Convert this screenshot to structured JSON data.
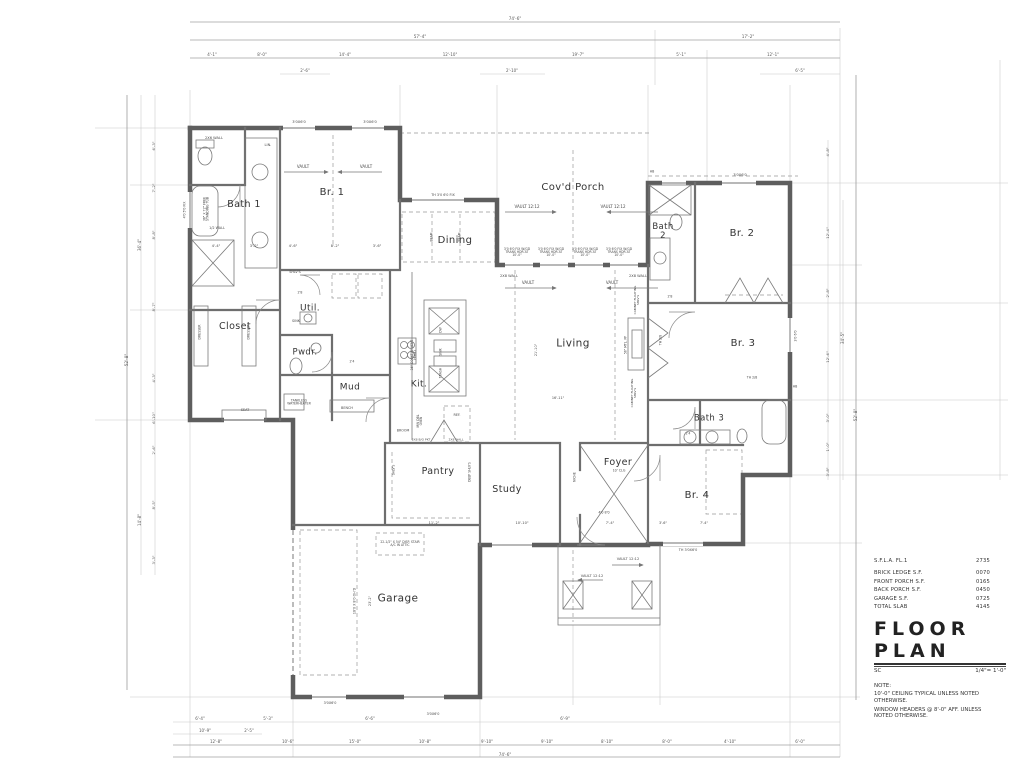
{
  "title_block": {
    "rows": [
      {
        "label": "S.F.L.A. FL.1",
        "value": "2735"
      },
      {
        "label": "BRICK LEDGE S.F.",
        "value": "0070"
      },
      {
        "label": "FRONT PORCH S.F.",
        "value": "0165"
      },
      {
        "label": "BACK PORCH S.F.",
        "value": "0450"
      },
      {
        "label": "GARAGE S.F.",
        "value": "0725"
      },
      {
        "label": "TOTAL SLAB",
        "value": "4145"
      }
    ],
    "title": "FLOOR PLAN",
    "sheet": "SC",
    "scale": "1/4\"= 1'-0\"",
    "note_heading": "NOTE:",
    "notes": [
      "10'-0\" CEILING TYPICAL UNLESS NOTED OTHERWISE.",
      "WINDOW HEADERS @ 8'-0\" AFF. UNLESS NOTED OTHERWISE."
    ]
  },
  "labels": {
    "rooms": [
      {
        "t": "Bath 1",
        "x": 244,
        "y": 205,
        "s": 9.5
      },
      {
        "t": "Br. 1",
        "x": 332,
        "y": 193,
        "s": 10
      },
      {
        "t": "Cov'd Porch",
        "x": 573,
        "y": 188,
        "s": 10
      },
      {
        "t": "Bath 2",
        "x": 663,
        "y": 232,
        "s": 8.5,
        "w": 26
      },
      {
        "t": "Br. 2",
        "x": 742,
        "y": 234,
        "s": 10
      },
      {
        "t": "Dining",
        "x": 455,
        "y": 241,
        "s": 10
      },
      {
        "t": "Closet",
        "x": 235,
        "y": 327,
        "s": 9.5
      },
      {
        "t": "Util.",
        "x": 310,
        "y": 309,
        "s": 9
      },
      {
        "t": "Pwdr.",
        "x": 305,
        "y": 353,
        "s": 8.5
      },
      {
        "t": "Mud",
        "x": 350,
        "y": 388,
        "s": 9
      },
      {
        "t": "Kit.",
        "x": 419,
        "y": 385,
        "s": 9
      },
      {
        "t": "Living",
        "x": 573,
        "y": 344,
        "s": 10.5
      },
      {
        "t": "Br. 3",
        "x": 743,
        "y": 344,
        "s": 10
      },
      {
        "t": "Pantry",
        "x": 438,
        "y": 472,
        "s": 9.5
      },
      {
        "t": "Study",
        "x": 507,
        "y": 490,
        "s": 9.5
      },
      {
        "t": "Foyer",
        "x": 618,
        "y": 463,
        "s": 9.5
      },
      {
        "t": "Bath 3",
        "x": 709,
        "y": 419,
        "s": 8.5
      },
      {
        "t": "Br. 4",
        "x": 697,
        "y": 496,
        "s": 10
      },
      {
        "t": "Garage",
        "x": 398,
        "y": 599,
        "s": 10.5
      }
    ],
    "annotations": [
      {
        "t": "2X6 WALL",
        "x": 214,
        "y": 139,
        "s": 3.6
      },
      {
        "t": "LIN.",
        "x": 268,
        "y": 146,
        "s": 3.6
      },
      {
        "t": "3'0X6'0",
        "x": 299,
        "y": 123,
        "s": 3.6
      },
      {
        "t": "3'0X6'0",
        "x": 370,
        "y": 123,
        "s": 3.6
      },
      {
        "t": "3'0X6'0",
        "x": 740,
        "y": 176,
        "s": 3.6
      },
      {
        "t": "VAULT",
        "x": 303,
        "y": 167,
        "s": 4
      },
      {
        "t": "VAULT",
        "x": 366,
        "y": 167,
        "s": 4
      },
      {
        "t": "VAULT 12:12",
        "x": 527,
        "y": 207,
        "s": 4
      },
      {
        "t": "VAULT 12:12",
        "x": 613,
        "y": 207,
        "s": 4
      },
      {
        "t": "VAULT",
        "x": 528,
        "y": 283,
        "s": 4
      },
      {
        "t": "VAULT",
        "x": 612,
        "y": 283,
        "s": 4
      },
      {
        "t": "VAULT 12:12",
        "x": 592,
        "y": 577,
        "s": 3.6
      },
      {
        "t": "VAULT 12:12",
        "x": 628,
        "y": 560,
        "s": 3.6
      },
      {
        "t": "36\" X 72\" FREE STANDING TUB",
        "x": 207,
        "y": 209,
        "s": 3.2,
        "r": -90,
        "w": 34
      },
      {
        "t": "1/2 WALL",
        "x": 217,
        "y": 229,
        "s": 3.4
      },
      {
        "t": "4'0 5'0 FIX",
        "x": 185,
        "y": 210,
        "s": 3.2,
        "r": -90
      },
      {
        "t": "4'-4\"",
        "x": 216,
        "y": 247,
        "s": 3.6
      },
      {
        "t": "3'-2\"",
        "x": 254,
        "y": 247,
        "s": 3.6
      },
      {
        "t": "4'-6\"",
        "x": 293,
        "y": 247,
        "s": 3.6
      },
      {
        "t": "8'-2\"",
        "x": 335,
        "y": 247,
        "s": 3.6
      },
      {
        "t": "3'-6\"",
        "x": 377,
        "y": 247,
        "s": 3.6
      },
      {
        "t": "DRESSER",
        "x": 200,
        "y": 332,
        "s": 3.2,
        "r": -90
      },
      {
        "t": "DRESSER",
        "x": 249,
        "y": 332,
        "s": 3.2,
        "r": -90
      },
      {
        "t": "SHLV'S",
        "x": 295,
        "y": 273,
        "s": 3.4
      },
      {
        "t": "SINK",
        "x": 296,
        "y": 322,
        "s": 3.4
      },
      {
        "t": "2X8 WALL",
        "x": 509,
        "y": 277,
        "s": 3.6
      },
      {
        "t": "2X8 WALL",
        "x": 638,
        "y": 277,
        "s": 3.6
      },
      {
        "t": "TH 3'0 6'0 FIX",
        "x": 443,
        "y": 196,
        "s": 3.4
      },
      {
        "t": "3'0 6'0 FIX W/GD TRANS HDR AT 10'-0\"",
        "x": 517,
        "y": 253,
        "s": 3.1,
        "w": 28
      },
      {
        "t": "3'0 6'0 FIX W/GD TRANS HDR AT 10'-0\"",
        "x": 551,
        "y": 253,
        "s": 3.1,
        "w": 28
      },
      {
        "t": "3'0 6'0 FIX W/GD TRANS HDR AT 10'-0\"",
        "x": 585,
        "y": 253,
        "s": 3.1,
        "w": 28
      },
      {
        "t": "3'0 6'0 FIX W/GD TRANS HDR AT 10'-0\"",
        "x": 619,
        "y": 253,
        "s": 3.1,
        "w": 28
      },
      {
        "t": "TANKLESS WATERHEATER",
        "x": 299,
        "y": 403,
        "s": 3.2,
        "w": 32
      },
      {
        "t": "SEAT",
        "x": 245,
        "y": 411,
        "s": 3.4
      },
      {
        "t": "BENCH",
        "x": 347,
        "y": 409,
        "s": 3.4
      },
      {
        "t": "BROOM",
        "x": 403,
        "y": 431,
        "s": 3.3
      },
      {
        "t": "36\" COOKTOP VENT HOOD",
        "x": 414,
        "y": 355,
        "s": 3.1,
        "r": -90,
        "w": 36
      },
      {
        "t": "MW DBL OVEN",
        "x": 420,
        "y": 421,
        "s": 3.1,
        "r": -90,
        "w": 20
      },
      {
        "t": "REF.",
        "x": 457,
        "y": 416,
        "s": 3.4
      },
      {
        "t": "DW",
        "x": 441,
        "y": 330,
        "s": 3.1,
        "r": -90
      },
      {
        "t": "SINK",
        "x": 441,
        "y": 352,
        "s": 3.1,
        "r": -90
      },
      {
        "t": "TRASH",
        "x": 441,
        "y": 373,
        "s": 3.1,
        "r": -90
      },
      {
        "t": "BEAM",
        "x": 432,
        "y": 237,
        "s": 3.1,
        "r": -90
      },
      {
        "t": "BEAM",
        "x": 460,
        "y": 237,
        "s": 3.1,
        "r": -90
      },
      {
        "t": "56\" MTL. FP",
        "x": 626,
        "y": 345,
        "s": 3.1,
        "r": -90
      },
      {
        "t": "CABINET FLOATING SHLV'S",
        "x": 637,
        "y": 300,
        "s": 3,
        "r": -90,
        "w": 34
      },
      {
        "t": "CABINET FLOATING SHLV'S",
        "x": 634,
        "y": 393,
        "s": 3,
        "r": -90,
        "w": 34
      },
      {
        "t": "21'-10\"",
        "x": 537,
        "y": 350,
        "s": 3.4,
        "r": -90
      },
      {
        "t": "16'-11\"",
        "x": 558,
        "y": 399,
        "s": 3.4
      },
      {
        "t": "DEEP SHLV'S",
        "x": 470,
        "y": 472,
        "s": 3.1,
        "r": -90,
        "w": 20
      },
      {
        "t": "SHLV'S",
        "x": 394,
        "y": 470,
        "s": 3.1,
        "r": -90
      },
      {
        "t": "NICHE",
        "x": 575,
        "y": 477,
        "s": 3.1,
        "r": -90
      },
      {
        "t": "11'-2\"",
        "x": 434,
        "y": 524,
        "s": 3.6
      },
      {
        "t": "10'-10\"",
        "x": 522,
        "y": 524,
        "s": 3.6
      },
      {
        "t": "7'-4\"",
        "x": 610,
        "y": 524,
        "s": 3.6
      },
      {
        "t": "4'0 8'0",
        "x": 604,
        "y": 513,
        "s": 3.3
      },
      {
        "t": "10' CLG",
        "x": 619,
        "y": 471,
        "s": 3.3
      },
      {
        "t": "22-1/2\" X 54\" DISP. STAIR A/C IN ATTIC",
        "x": 400,
        "y": 544,
        "s": 3.1,
        "w": 40
      },
      {
        "t": "18'0 X 8'0 OH'D",
        "x": 355,
        "y": 601,
        "s": 3.3,
        "r": -90
      },
      {
        "t": "23'-2\"",
        "x": 371,
        "y": 601,
        "s": 3.4,
        "r": -90
      },
      {
        "t": "3'0X6'0",
        "x": 330,
        "y": 704,
        "s": 3.4
      },
      {
        "t": "3'0X6'0",
        "x": 433,
        "y": 715,
        "s": 3.4
      },
      {
        "t": "TH 3'0X6'0",
        "x": 688,
        "y": 551,
        "s": 3.4
      },
      {
        "t": "3'0 6'0",
        "x": 796,
        "y": 336,
        "s": 3.3,
        "r": -90
      },
      {
        "t": "HB",
        "x": 795,
        "y": 387,
        "s": 3.2
      },
      {
        "t": "HB",
        "x": 652,
        "y": 172,
        "s": 3.2
      },
      {
        "t": "2'8",
        "x": 300,
        "y": 293,
        "s": 3.2
      },
      {
        "t": "2'4",
        "x": 352,
        "y": 362,
        "s": 3.2
      },
      {
        "t": "2'8",
        "x": 670,
        "y": 297,
        "s": 3.2
      },
      {
        "t": "2'4",
        "x": 688,
        "y": 434,
        "s": 3.2
      },
      {
        "t": "TH 2/8",
        "x": 752,
        "y": 378,
        "s": 3.2
      },
      {
        "t": "TH 2/8",
        "x": 661,
        "y": 340,
        "s": 3.2,
        "r": -90
      },
      {
        "t": "3'-6\"",
        "x": 663,
        "y": 524,
        "s": 3.4
      },
      {
        "t": "7'-4\"",
        "x": 704,
        "y": 524,
        "s": 3.4
      },
      {
        "t": "2X8 B/O PKT",
        "x": 421,
        "y": 440,
        "s": 3
      },
      {
        "t": "2X8 WALL",
        "x": 456,
        "y": 440,
        "s": 3
      }
    ],
    "dimensions": [
      {
        "t": "74'-6\"",
        "x": 515,
        "y": 19,
        "s": 4.2
      },
      {
        "t": "57'-4\"",
        "x": 420,
        "y": 37,
        "s": 4.2
      },
      {
        "t": "17'-2\"",
        "x": 748,
        "y": 37,
        "s": 4.2
      },
      {
        "t": "4'-1\"",
        "x": 212,
        "y": 55,
        "s": 4
      },
      {
        "t": "8'-0\"",
        "x": 262,
        "y": 55,
        "s": 4
      },
      {
        "t": "14'-4\"",
        "x": 345,
        "y": 55,
        "s": 4
      },
      {
        "t": "12'-10\"",
        "x": 450,
        "y": 55,
        "s": 4
      },
      {
        "t": "19'-7\"",
        "x": 578,
        "y": 55,
        "s": 4
      },
      {
        "t": "5'-1\"",
        "x": 681,
        "y": 55,
        "s": 4
      },
      {
        "t": "12'-1\"",
        "x": 773,
        "y": 55,
        "s": 4
      },
      {
        "t": "2'-6\"",
        "x": 305,
        "y": 71,
        "s": 4
      },
      {
        "t": "2'-10\"",
        "x": 512,
        "y": 71,
        "s": 4
      },
      {
        "t": "6'-5\"",
        "x": 800,
        "y": 71,
        "s": 4
      },
      {
        "t": "6'-4\"",
        "x": 200,
        "y": 719,
        "s": 4
      },
      {
        "t": "5'-3\"",
        "x": 268,
        "y": 719,
        "s": 4
      },
      {
        "t": "6'-6\"",
        "x": 370,
        "y": 719,
        "s": 4
      },
      {
        "t": "6'-9\"",
        "x": 565,
        "y": 719,
        "s": 4
      },
      {
        "t": "10'-9\"",
        "x": 205,
        "y": 731,
        "s": 4
      },
      {
        "t": "2'-5\"",
        "x": 249,
        "y": 731,
        "s": 4
      },
      {
        "t": "12'-8\"",
        "x": 216,
        "y": 742,
        "s": 4
      },
      {
        "t": "10'-6\"",
        "x": 288,
        "y": 742,
        "s": 4
      },
      {
        "t": "15'-0\"",
        "x": 355,
        "y": 742,
        "s": 4
      },
      {
        "t": "10'-8\"",
        "x": 425,
        "y": 742,
        "s": 4
      },
      {
        "t": "9'-10\"",
        "x": 487,
        "y": 742,
        "s": 4
      },
      {
        "t": "9'-10\"",
        "x": 547,
        "y": 742,
        "s": 4
      },
      {
        "t": "8'-10\"",
        "x": 607,
        "y": 742,
        "s": 4
      },
      {
        "t": "8'-0\"",
        "x": 667,
        "y": 742,
        "s": 4
      },
      {
        "t": "4'-10\"",
        "x": 730,
        "y": 742,
        "s": 4
      },
      {
        "t": "6'-0\"",
        "x": 800,
        "y": 742,
        "s": 4
      },
      {
        "t": "74'-6\"",
        "x": 505,
        "y": 755,
        "s": 4.2
      },
      {
        "t": "52'-8\"",
        "x": 127,
        "y": 360,
        "s": 4.2,
        "r": -90
      },
      {
        "t": "36'-4\"",
        "x": 140,
        "y": 245,
        "s": 4,
        "r": -90
      },
      {
        "t": "14'-8\"",
        "x": 140,
        "y": 520,
        "s": 4,
        "r": -90
      },
      {
        "t": "6'-3\"",
        "x": 154,
        "y": 146,
        "s": 3.8,
        "r": -90
      },
      {
        "t": "7'-2\"",
        "x": 154,
        "y": 188,
        "s": 3.8,
        "r": -90
      },
      {
        "t": "8'-8\"",
        "x": 154,
        "y": 235,
        "s": 3.8,
        "r": -90
      },
      {
        "t": "8'-7\"",
        "x": 154,
        "y": 307,
        "s": 3.8,
        "r": -90
      },
      {
        "t": "4'-3\"",
        "x": 154,
        "y": 378,
        "s": 3.8,
        "r": -90
      },
      {
        "t": "6'-10\"",
        "x": 154,
        "y": 418,
        "s": 3.8,
        "r": -90
      },
      {
        "t": "2'-6\"",
        "x": 154,
        "y": 450,
        "s": 3.8,
        "r": -90
      },
      {
        "t": "8'-5\"",
        "x": 154,
        "y": 505,
        "s": 3.8,
        "r": -90
      },
      {
        "t": "3'-3\"",
        "x": 154,
        "y": 560,
        "s": 3.8,
        "r": -90
      },
      {
        "t": "4'-8\"",
        "x": 828,
        "y": 152,
        "s": 3.8,
        "r": -90
      },
      {
        "t": "12'-4\"",
        "x": 828,
        "y": 233,
        "s": 3.8,
        "r": -90
      },
      {
        "t": "2'-8\"",
        "x": 828,
        "y": 293,
        "s": 3.8,
        "r": -90
      },
      {
        "t": "12'-6\"",
        "x": 828,
        "y": 357,
        "s": 3.8,
        "r": -90
      },
      {
        "t": "3'-0\"",
        "x": 828,
        "y": 418,
        "s": 3.8,
        "r": -90
      },
      {
        "t": "1'-0\"",
        "x": 828,
        "y": 447,
        "s": 3.8,
        "r": -90
      },
      {
        "t": "3'-8\"",
        "x": 828,
        "y": 472,
        "s": 3.8,
        "r": -90
      },
      {
        "t": "34'-5\"",
        "x": 843,
        "y": 338,
        "s": 4,
        "r": -90
      },
      {
        "t": "52'-8\"",
        "x": 856,
        "y": 415,
        "s": 4.2,
        "r": -90
      }
    ]
  }
}
